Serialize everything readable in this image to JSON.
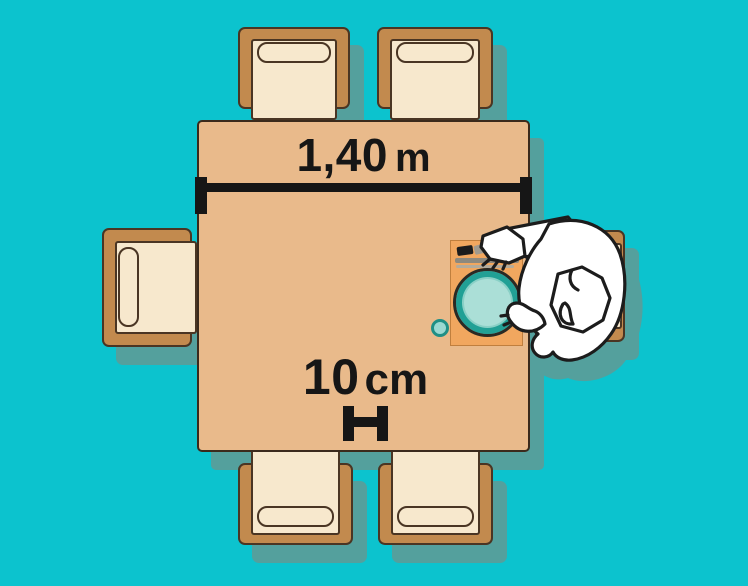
{
  "scene": {
    "description": "Top-down plan illustration of a 1,40 m dining table with four chairs; a seated person at the right with placemat, plate, glass and cutlery",
    "background_color": "#0cc3ce"
  },
  "labels": {
    "table_width": {
      "value": "1,40",
      "unit": "m"
    },
    "place_margin": {
      "value": "10",
      "unit": "cm"
    }
  },
  "palette": {
    "background": "#0cc3ce",
    "shadow": "#54a09d",
    "table": "#e9ba8b",
    "chair_frame": "#c28a4e",
    "chair_seat": "#f7e8cd",
    "wood_outline": "#4a3523",
    "placemat": "#f1a75f",
    "plate_rim": "#21a095",
    "plate_fill": "#abdfd7",
    "dimension_ink": "#161616",
    "person_fill": "#ffffff",
    "person_outline": "#1c1c1c"
  },
  "objects": [
    "table",
    "chair-top-left",
    "chair-top-right",
    "chair-left",
    "chair-right",
    "chair-bottom-left",
    "chair-bottom-right",
    "person",
    "placemat",
    "plate",
    "glass",
    "cutlery",
    "width-dimension",
    "margin-dimension"
  ]
}
